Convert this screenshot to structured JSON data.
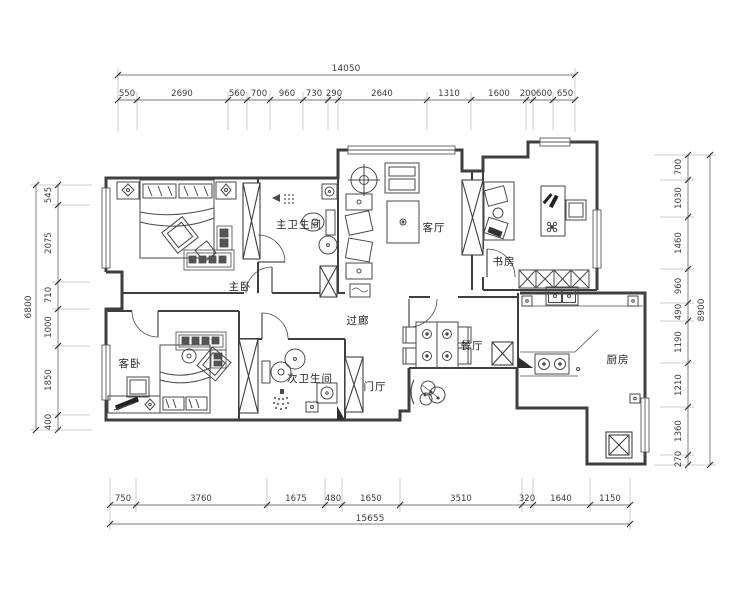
{
  "drawing": {
    "type": "apartment-floor-plan",
    "rooms": {
      "master_bedroom": "主卧",
      "master_bath": "主卫生间",
      "living_room": "客厅",
      "study": "书房",
      "corridor": "过廊",
      "guest_bedroom": "客卧",
      "second_bath": "次卫生间",
      "foyer": "门厅",
      "dining_room": "餐厅",
      "kitchen": "厨房"
    },
    "dimensions": {
      "top": {
        "total": "14050",
        "segments": [
          "550",
          "2690",
          "560",
          "700",
          "960",
          "730",
          "290",
          "2640",
          "1310",
          "1600",
          "200",
          "600",
          "650"
        ]
      },
      "bottom": {
        "total": "15655",
        "segments": [
          "750",
          "3760",
          "1675",
          "480",
          "1650",
          "3510",
          "320",
          "1640",
          "1150"
        ]
      },
      "left": {
        "total": "6800",
        "segments": [
          "545",
          "2075",
          "710",
          "1000",
          "1850",
          "400"
        ]
      },
      "right": {
        "total": "8900",
        "segments": [
          "700",
          "1030",
          "1460",
          "960",
          "490",
          "1190",
          "1210",
          "1360",
          "270"
        ]
      }
    },
    "colors": {
      "wall": "#3f3f3f",
      "line": "#4a4a4a",
      "dim": "#4d4d4d",
      "background": "#ffffff"
    }
  }
}
